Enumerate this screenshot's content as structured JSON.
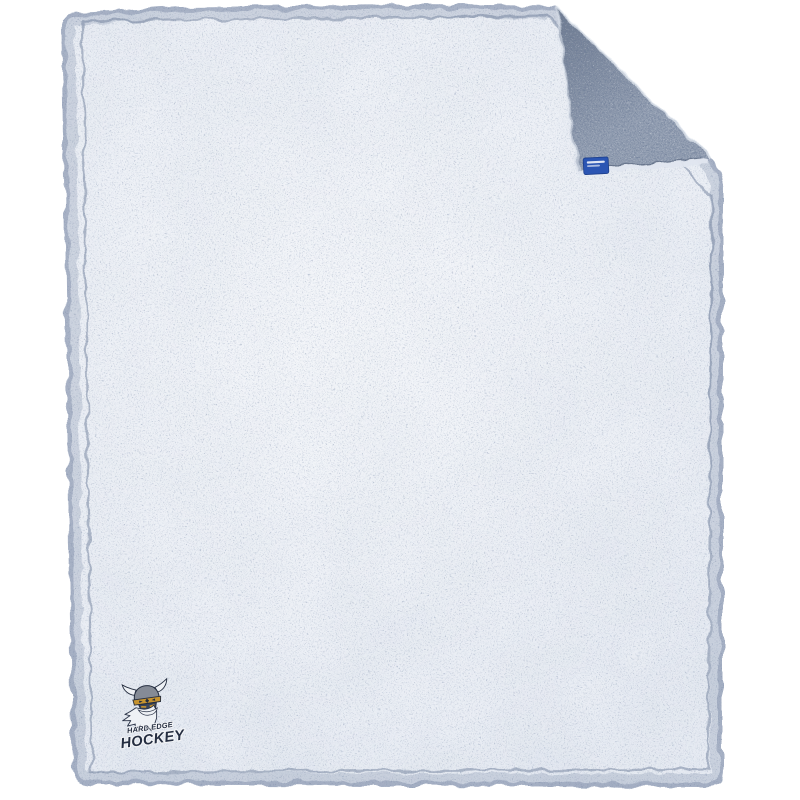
{
  "canvas": {
    "background": "#ffffff"
  },
  "product": {
    "kind": "sherpa-fleece-blanket",
    "blanket": {
      "front_color": "#e9edf4",
      "fleck_color": "#2c3d59",
      "back_color": "#99a4b6",
      "edge_color": "#55678a",
      "seam_color": "#6d7e9a",
      "fringe_color": "#e0e6ef"
    },
    "tag": {
      "color": "#2b55b3",
      "border_color": "#1d3f8c"
    },
    "logo": {
      "line1": "HARD EDGE",
      "line2": "HOCKEY",
      "navy": "#252e41",
      "white": "#eef1f5",
      "gold": "#c6932f",
      "helmet_gray": "#858b96",
      "face_navy": "#39445a"
    }
  }
}
